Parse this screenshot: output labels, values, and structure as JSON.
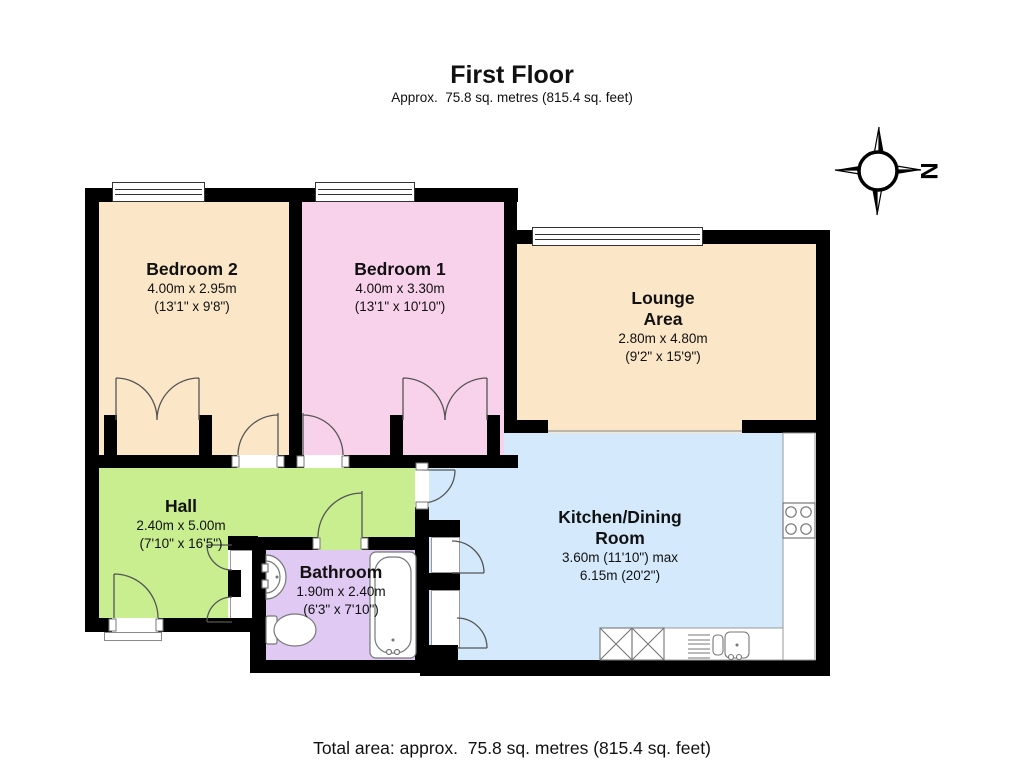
{
  "header": {
    "title": "First Floor",
    "subtitle": "Approx.  75.8 sq. metres (815.4 sq. feet)"
  },
  "compass": {
    "north_label": "N"
  },
  "plan": {
    "wall_color": "#000000"
  },
  "rooms": {
    "bedroom2": {
      "name": "Bedroom 2",
      "metric": "4.00m x 2.95m",
      "imperial": "(13'1\" x 9'8\")",
      "color": "#fbe7c8"
    },
    "bedroom1": {
      "name": "Bedroom 1",
      "metric": "4.00m x 3.30m",
      "imperial": "(13'1\" x 10'10\")",
      "color": "#f8d2ea"
    },
    "lounge": {
      "name_line1": "Lounge",
      "name_line2": "Area",
      "metric": "2.80m x 4.80m",
      "imperial": "(9'2\" x 15'9\")",
      "color": "#fbe7c8"
    },
    "hall": {
      "name": "Hall",
      "metric": "2.40m x 5.00m",
      "imperial": "(7'10\" x 16'5\")",
      "color": "#c9ee90"
    },
    "bathroom": {
      "name": "Bathroom",
      "metric": "1.90m x 2.40m",
      "imperial": "(6'3\" x 7'10\")",
      "color": "#e0c9f2"
    },
    "kitchen": {
      "name_line1": "Kitchen/Dining",
      "name_line2": "Room",
      "metric": "3.60m (11'10\") max",
      "imperial": "6.15m (20'2\")",
      "color": "#d4eafc"
    }
  },
  "footer": {
    "total": "Total area: approx.  75.8 sq. metres (815.4 sq. feet)"
  }
}
